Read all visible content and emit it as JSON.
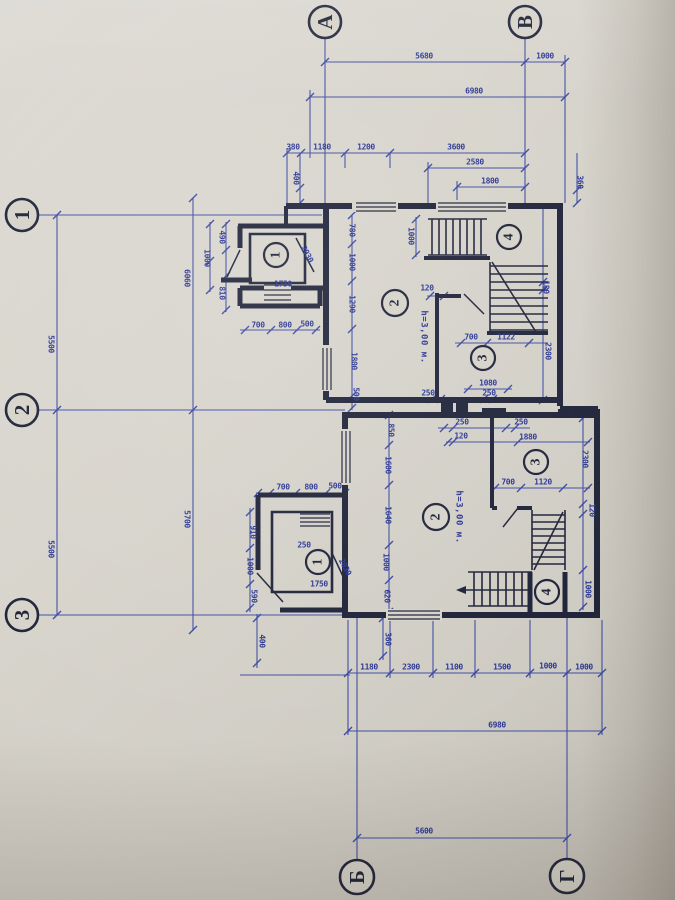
{
  "colors": {
    "paper": "#d6d3ca",
    "wall_ink": "#20243a",
    "dim_ink": "#3443a0"
  },
  "axes": {
    "top": [
      {
        "label": "А"
      },
      {
        "label": "В"
      }
    ],
    "left": [
      {
        "label": "1"
      },
      {
        "label": "2"
      },
      {
        "label": "3"
      }
    ],
    "bottom": [
      {
        "label": "Б"
      },
      {
        "label": "Г"
      }
    ]
  },
  "rooms": [
    {
      "number": "1",
      "block": "upper-annex"
    },
    {
      "number": "2",
      "block": "upper-main",
      "height": "h=3,00 м."
    },
    {
      "number": "3",
      "block": "upper"
    },
    {
      "number": "4",
      "block": "upper-stair"
    },
    {
      "number": "1",
      "block": "lower-annex"
    },
    {
      "number": "2",
      "block": "lower-main",
      "height": "h=3,00 м."
    },
    {
      "number": "3",
      "block": "lower"
    },
    {
      "number": "4",
      "block": "lower-stair"
    }
  ],
  "height_labels": [
    "h=3,00 м.",
    "h=3,00 м."
  ],
  "dim_labels": [
    {
      "v": "5680",
      "x": 424,
      "y": 56,
      "r": 0
    },
    {
      "v": "1000",
      "x": 545,
      "y": 56,
      "r": 0
    },
    {
      "v": "6980",
      "x": 474,
      "y": 91,
      "r": 0
    },
    {
      "v": "380",
      "x": 293,
      "y": 147,
      "r": 0
    },
    {
      "v": "1180",
      "x": 322,
      "y": 147,
      "r": 0
    },
    {
      "v": "1200",
      "x": 366,
      "y": 147,
      "r": 0
    },
    {
      "v": "3600",
      "x": 456,
      "y": 147,
      "r": 0
    },
    {
      "v": "2580",
      "x": 475,
      "y": 162,
      "r": 0
    },
    {
      "v": "1800",
      "x": 490,
      "y": 181,
      "r": 0
    },
    {
      "v": "400",
      "x": 296,
      "y": 178,
      "r": 90
    },
    {
      "v": "360",
      "x": 580,
      "y": 182,
      "r": 90
    },
    {
      "v": "5500",
      "x": 51,
      "y": 344,
      "r": 90
    },
    {
      "v": "5500",
      "x": 51,
      "y": 549,
      "r": 90
    },
    {
      "v": "6060",
      "x": 187,
      "y": 278,
      "r": 90
    },
    {
      "v": "5700",
      "x": 187,
      "y": 519,
      "r": 90
    },
    {
      "v": "490",
      "x": 222,
      "y": 237,
      "r": 90
    },
    {
      "v": "1000",
      "x": 207,
      "y": 258,
      "r": 90
    },
    {
      "v": "810",
      "x": 222,
      "y": 293,
      "r": 90
    },
    {
      "v": "1750",
      "x": 283,
      "y": 284,
      "r": 0
    },
    {
      "v": "700",
      "x": 258,
      "y": 325,
      "r": 0
    },
    {
      "v": "800",
      "x": 285,
      "y": 325,
      "r": 0
    },
    {
      "v": "500",
      "x": 307,
      "y": 324,
      "r": 0
    },
    {
      "v": "2030",
      "x": 307,
      "y": 254,
      "r": 62
    },
    {
      "v": "780",
      "x": 352,
      "y": 230,
      "r": 90
    },
    {
      "v": "1000",
      "x": 352,
      "y": 262,
      "r": 90
    },
    {
      "v": "1290",
      "x": 352,
      "y": 304,
      "r": 90
    },
    {
      "v": "1800",
      "x": 354,
      "y": 361,
      "r": 90
    },
    {
      "v": "500",
      "x": 356,
      "y": 394,
      "r": 90
    },
    {
      "v": "1000",
      "x": 411,
      "y": 236,
      "r": 90
    },
    {
      "v": "120",
      "x": 427,
      "y": 288,
      "r": 0
    },
    {
      "v": "700",
      "x": 471,
      "y": 337,
      "r": 0
    },
    {
      "v": "1122",
      "x": 506,
      "y": 337,
      "r": 0
    },
    {
      "v": "1080",
      "x": 488,
      "y": 383,
      "r": 0
    },
    {
      "v": "250",
      "x": 428,
      "y": 393,
      "r": 0
    },
    {
      "v": "250",
      "x": 489,
      "y": 393,
      "r": 0
    },
    {
      "v": "180",
      "x": 546,
      "y": 287,
      "r": 90
    },
    {
      "v": "2300",
      "x": 548,
      "y": 351,
      "r": 90
    },
    {
      "v": "250",
      "x": 462,
      "y": 422,
      "r": 0
    },
    {
      "v": "250",
      "x": 521,
      "y": 422,
      "r": 0
    },
    {
      "v": "120",
      "x": 461,
      "y": 436,
      "r": 0
    },
    {
      "v": "1880",
      "x": 528,
      "y": 437,
      "r": 0
    },
    {
      "v": "850",
      "x": 391,
      "y": 430,
      "r": 90
    },
    {
      "v": "1600",
      "x": 388,
      "y": 465,
      "r": 90
    },
    {
      "v": "1640",
      "x": 388,
      "y": 515,
      "r": 90
    },
    {
      "v": "1000",
      "x": 386,
      "y": 562,
      "r": 90
    },
    {
      "v": "620",
      "x": 387,
      "y": 596,
      "r": 90
    },
    {
      "v": "700",
      "x": 283,
      "y": 487,
      "r": 0
    },
    {
      "v": "800",
      "x": 311,
      "y": 487,
      "r": 0
    },
    {
      "v": "500",
      "x": 335,
      "y": 486,
      "r": 0
    },
    {
      "v": "910",
      "x": 253,
      "y": 532,
      "r": 90
    },
    {
      "v": "1000",
      "x": 250,
      "y": 566,
      "r": 90
    },
    {
      "v": "590",
      "x": 254,
      "y": 596,
      "r": 90
    },
    {
      "v": "250",
      "x": 304,
      "y": 545,
      "r": 0
    },
    {
      "v": "1750",
      "x": 319,
      "y": 584,
      "r": 0
    },
    {
      "v": "2030",
      "x": 345,
      "y": 567,
      "r": 62
    },
    {
      "v": "400",
      "x": 262,
      "y": 641,
      "r": 90
    },
    {
      "v": "360",
      "x": 388,
      "y": 639,
      "r": 90
    },
    {
      "v": "700",
      "x": 508,
      "y": 482,
      "r": 0
    },
    {
      "v": "1120",
      "x": 543,
      "y": 482,
      "r": 0
    },
    {
      "v": "2300",
      "x": 585,
      "y": 459,
      "r": 90
    },
    {
      "v": "120",
      "x": 592,
      "y": 510,
      "r": 90
    },
    {
      "v": "1000",
      "x": 588,
      "y": 589,
      "r": 90
    },
    {
      "v": "1180",
      "x": 369,
      "y": 667,
      "r": 0
    },
    {
      "v": "2300",
      "x": 411,
      "y": 667,
      "r": 0
    },
    {
      "v": "1100",
      "x": 454,
      "y": 667,
      "r": 0
    },
    {
      "v": "1500",
      "x": 502,
      "y": 667,
      "r": 0
    },
    {
      "v": "1000",
      "x": 548,
      "y": 666,
      "r": 0
    },
    {
      "v": "1000",
      "x": 584,
      "y": 667,
      "r": 0
    },
    {
      "v": "6980",
      "x": 497,
      "y": 725,
      "r": 0
    },
    {
      "v": "5600",
      "x": 424,
      "y": 831,
      "r": 0
    }
  ]
}
